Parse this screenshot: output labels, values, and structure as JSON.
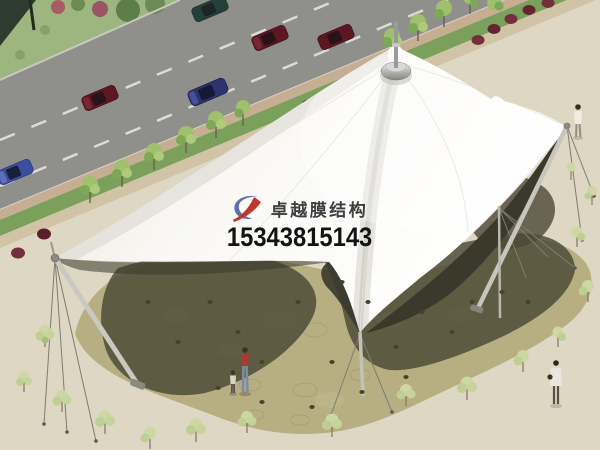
{
  "scene": {
    "label": "membrane-structure-aerial-rendering",
    "description": "Aerial 3D rendering of a white tensile membrane canopy with central spire over a flagstone plaza, beside a road with cars, tree-lined sidewalk, scattered small trees and pedestrians",
    "palette": {
      "road": "#8f8f8b",
      "plaza": "#ded7c3",
      "grass_strip": "#7aa05c",
      "sidewalk_inner": "#c6ae92",
      "sidewalk_outer": "#d0c3a6",
      "flagstone": "#b7ae82",
      "ground_shadow": "#4b4936",
      "membrane": "#f8f7f2",
      "membrane_underside": "#3a392c",
      "tree_foliage": "#ccd8a4",
      "red_bush": "#74303a",
      "car_red": "#5c1720",
      "car_blue": "#3a4f9f",
      "car_navy": "#2c3370",
      "mast": "#c6c6bc"
    }
  },
  "watermark": {
    "brand_text": "卓越膜结构",
    "phone_number": "15343815143",
    "logo_icon": "brand-logo-swoosh-icon",
    "logo_colors": {
      "blue": "#5f6fae",
      "red": "#c0392e"
    },
    "brand_text_color": "#3e3e40",
    "phone_text_color": "#131313"
  }
}
